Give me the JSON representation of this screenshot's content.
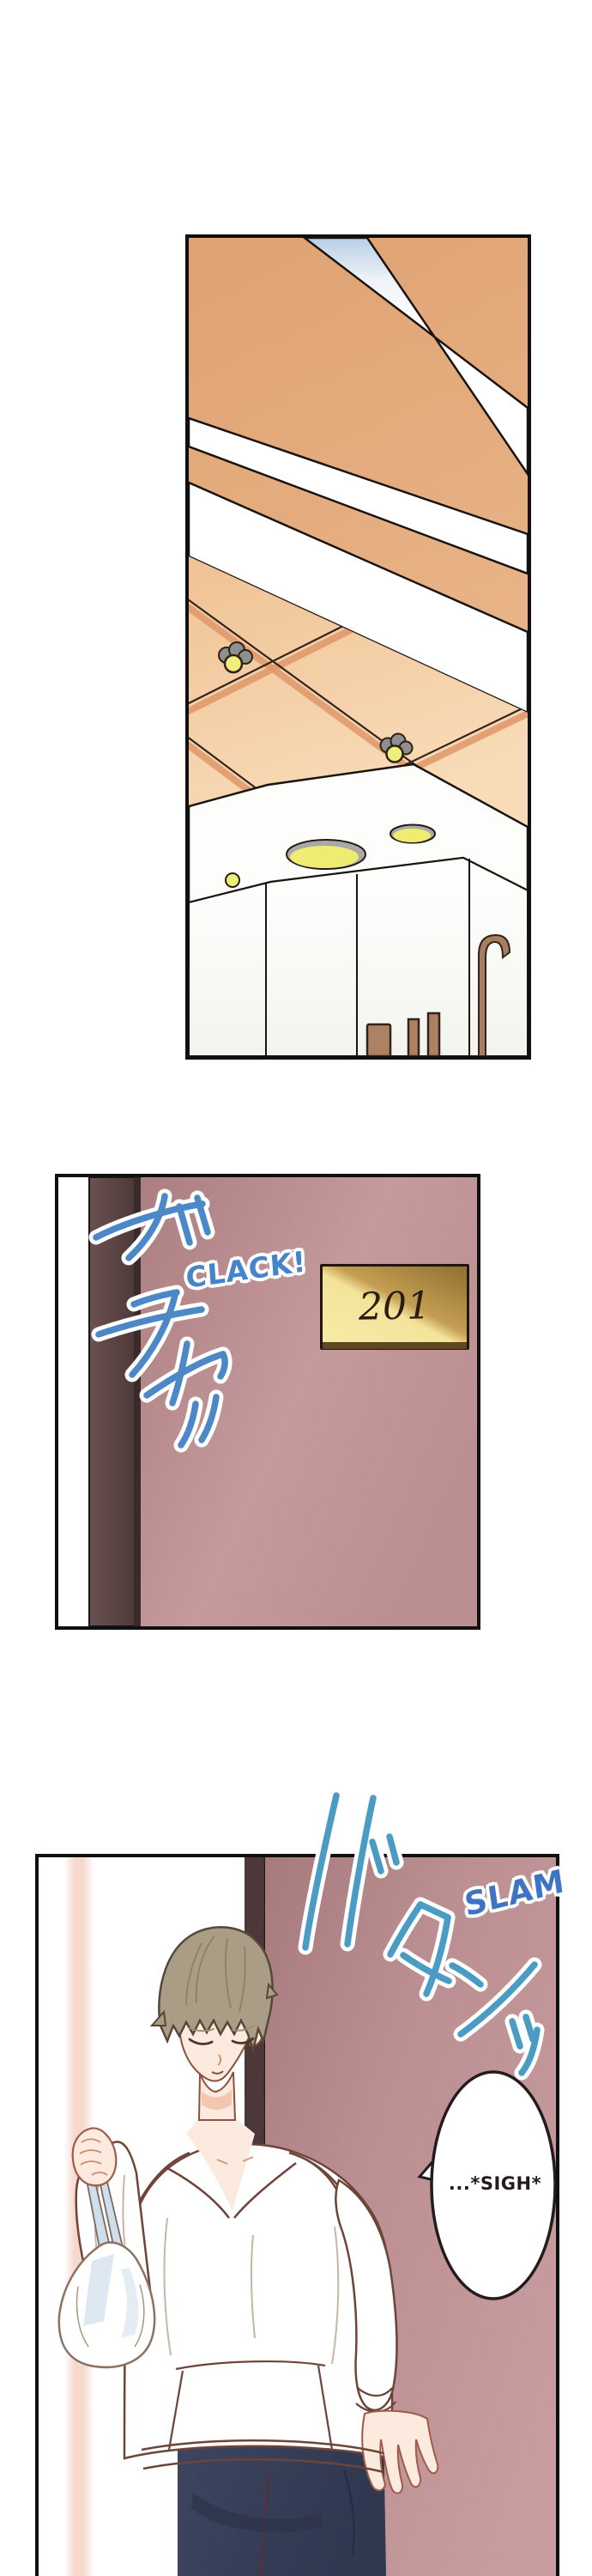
{
  "page": {
    "kind": "manga page",
    "panel_count": 3
  },
  "panel1": {
    "alt": "Hallway ceiling with orange wood panels, white diagonal beams, recessed round lights and a white soffit with oval lights"
  },
  "panel2": {
    "alt": "Room door being unlocked",
    "room_number": "201",
    "sfx_jp": "ガチャッ",
    "sfx_en": "CLACK!"
  },
  "panel3": {
    "alt": "Man in a white hoodie holding a plastic bag, eyes closed, standing in front of the closed door",
    "sfx_jp": "バタンッ",
    "sfx_en": "SLAM",
    "speech": "...*SIGH*"
  },
  "colors": {
    "sfx_blue": "#4c87c8",
    "sfx_teal": "#4a9cc4",
    "door_mauve": "#bb8f91",
    "door_frame_brown": "#4c3838",
    "plate_gold_light": "#f6e9a5",
    "plate_gold_dark": "#8f6e30",
    "ceiling_orange": "#e3ac7e",
    "hair_ash_brown": "#a99e85",
    "pants_navy": "#3a4157",
    "bag_shadow_blue": "#d8e4f0"
  }
}
